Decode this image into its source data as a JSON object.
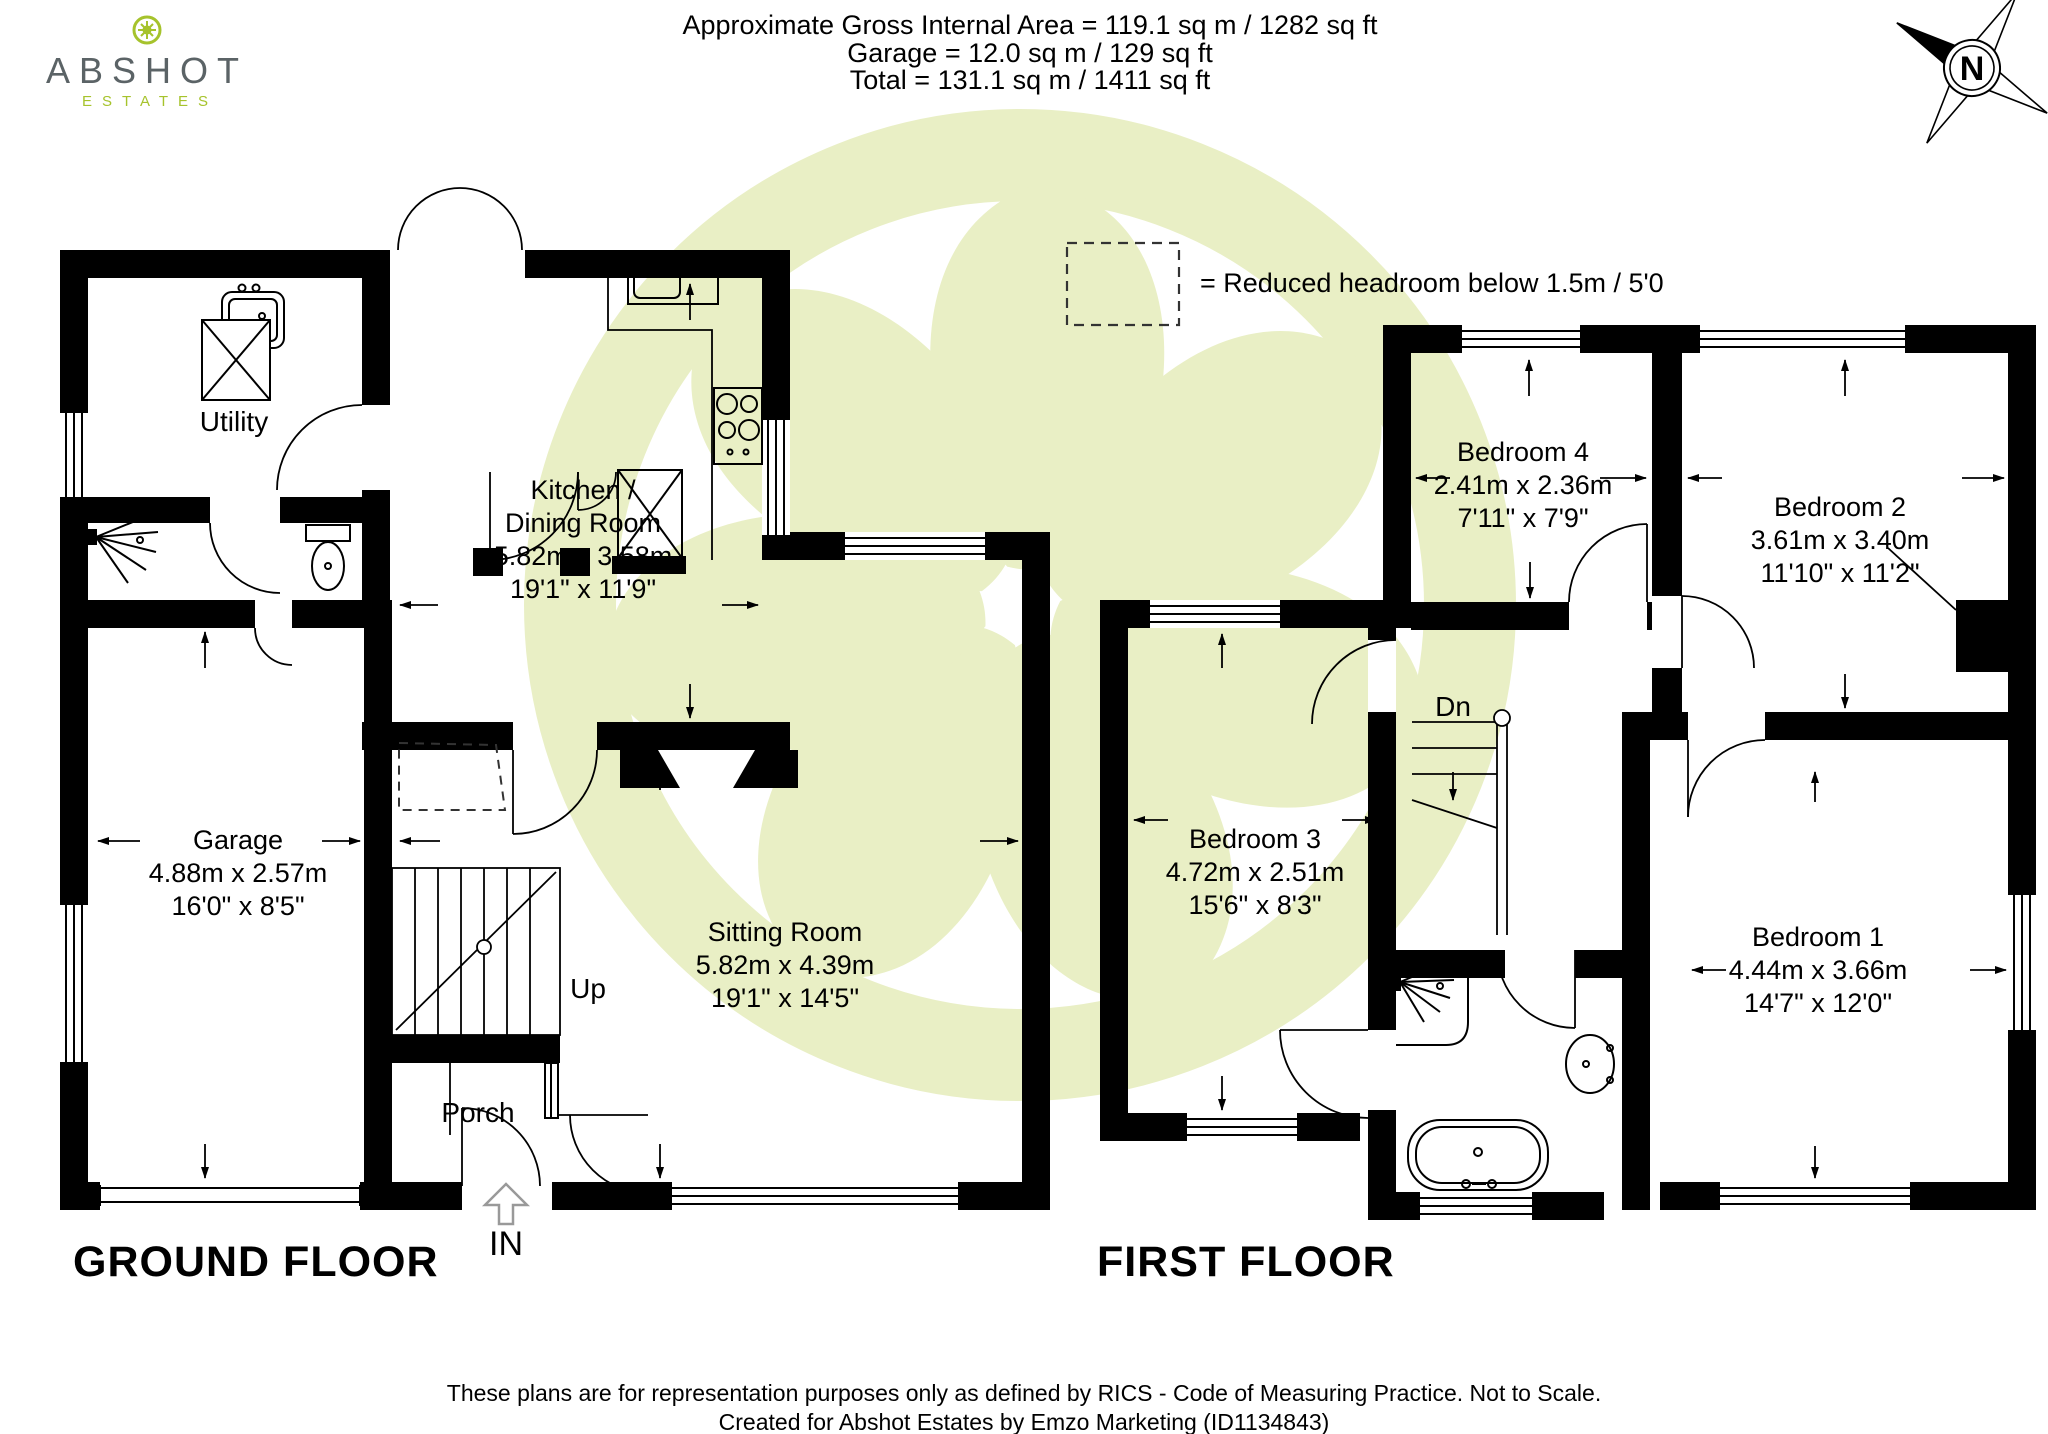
{
  "brand": {
    "name": "ABSHOT",
    "tagline": "ESTATES"
  },
  "area_summary": {
    "line1": "Approximate Gross Internal Area = 119.1 sq m / 1282 sq ft",
    "line2": "Garage = 12.0 sq m / 129 sq ft",
    "line3": "Total = 131.1 sq m / 1411 sq ft"
  },
  "compass": {
    "north_label": "N"
  },
  "legend": {
    "reduced_headroom": "= Reduced headroom below 1.5m / 5'0"
  },
  "ground_floor": {
    "title": "GROUND FLOOR",
    "rooms": {
      "utility": {
        "name": "Utility"
      },
      "kitchen": {
        "name_line1": "Kitchen /",
        "name_line2": "Dining Room",
        "metric": "5.82m x 3.58m",
        "imperial": "19'1\" x 11'9\""
      },
      "garage": {
        "name": "Garage",
        "metric": "4.88m x 2.57m",
        "imperial": "16'0\" x 8'5\""
      },
      "sitting_room": {
        "name": "Sitting Room",
        "metric": "5.82m x 4.39m",
        "imperial": "19'1\" x 14'5\""
      },
      "porch": {
        "name": "Porch"
      }
    },
    "stairs_label": "Up",
    "entrance_label": "IN"
  },
  "first_floor": {
    "title": "FIRST FLOOR",
    "rooms": {
      "bedroom1": {
        "name": "Bedroom 1",
        "metric": "4.44m x 3.66m",
        "imperial": "14'7\" x 12'0\""
      },
      "bedroom2": {
        "name": "Bedroom 2",
        "metric": "3.61m x 3.40m",
        "imperial": "11'10\" x 11'2\""
      },
      "bedroom3": {
        "name": "Bedroom 3",
        "metric": "4.72m x 2.51m",
        "imperial": "15'6\" x 8'3\""
      },
      "bedroom4": {
        "name": "Bedroom 4",
        "metric": "2.41m x 2.36m",
        "imperial": "7'11\" x 7'9\""
      }
    },
    "stairs_label": "Dn"
  },
  "footer": {
    "line1": "These plans are for representation purposes only as defined by RICS - Code of Measuring Practice. Not to Scale.",
    "line2": "Created for Abshot Estates by Emzo Marketing (ID1134843)"
  },
  "colors": {
    "watermark": "#e9efc5",
    "brand_green": "#a6c32c",
    "brand_grey": "#5b6366",
    "ink": "#000000"
  }
}
